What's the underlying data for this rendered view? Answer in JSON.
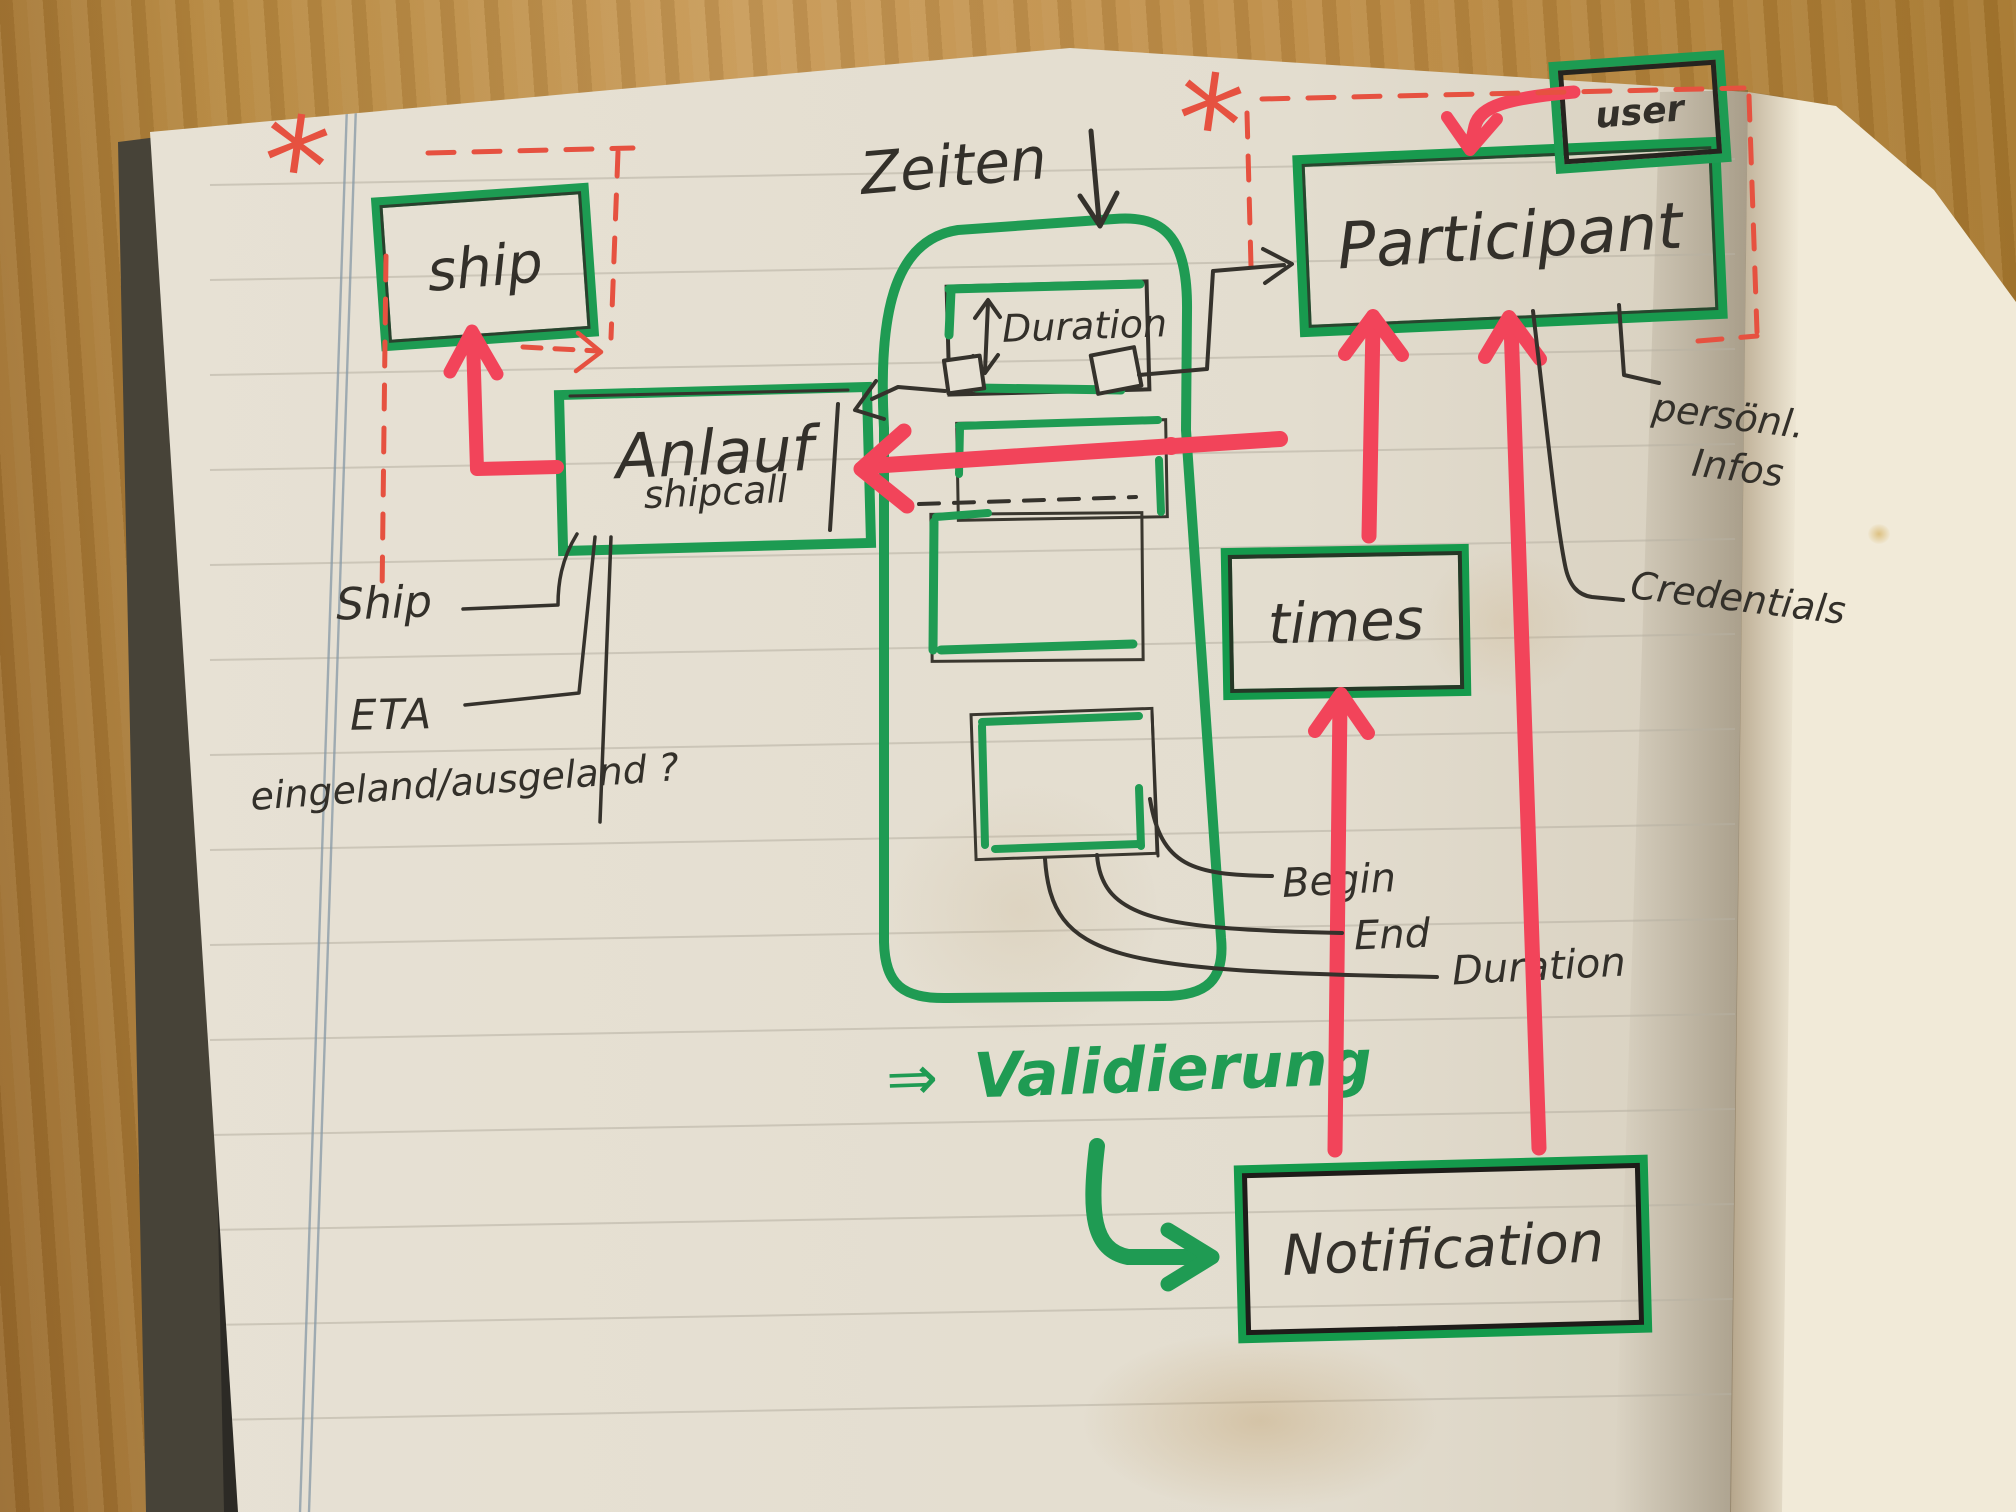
{
  "nodes": {
    "ship": {
      "label": "ship"
    },
    "anlauf": {
      "label": "Anlauf",
      "sublabel": "shipcall"
    },
    "duration": {
      "label": "Duration"
    },
    "participant": {
      "label": "Participant"
    },
    "user": {
      "label": "user"
    },
    "times": {
      "label": "times"
    },
    "notification": {
      "label": "Notification"
    }
  },
  "labels": {
    "zeiten": "Zeiten",
    "ship_attr": "Ship",
    "eta": "ETA",
    "in_out": "eingeland/ausgeland ?",
    "begin": "Begin",
    "end": "End",
    "duration_attr": "Duration",
    "personal_line1": "persönl.",
    "personal_line2": "Infos",
    "credentials": "Credentials",
    "validation_arrow": "⇒",
    "validation": "Validierung",
    "asterisk": "*"
  },
  "colors": {
    "marker_green": "#1f9b53",
    "marker_red": "#f2445a",
    "pen_red": "#e65140",
    "ink": "#35322c",
    "page": "#e5dfd2"
  }
}
